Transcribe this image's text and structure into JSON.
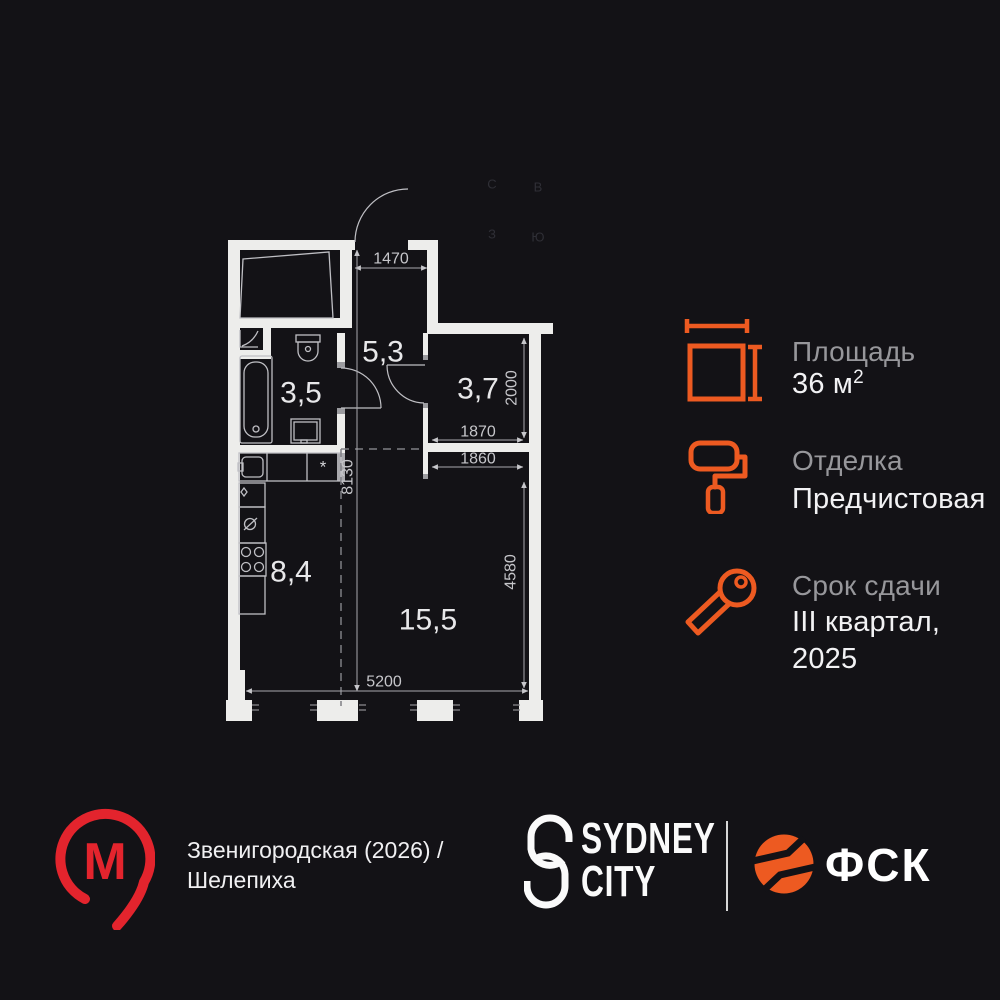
{
  "plan": {
    "room_labels": {
      "bathroom": "3,5",
      "hallway": "5,3",
      "bedroom": "3,7",
      "kitchen": "8,4",
      "living_room": "15,5"
    },
    "dimensions": {
      "hall_width": "1470",
      "bedroom_depth": "2000",
      "bedroom_width": "1870",
      "living_opening": "1860",
      "apartment_depth": "8130",
      "living_depth": "4580",
      "apartment_width": "5200"
    },
    "compass": {
      "north": "С",
      "east": "В",
      "west": "З",
      "south": "Ю"
    },
    "vent_symbol": "*"
  },
  "specs": {
    "area": {
      "label": "Площадь",
      "value": "36 м",
      "sup": "2"
    },
    "finishing": {
      "label": "Отделка",
      "value": "Предчистовая"
    },
    "deadline": {
      "label": "Срок сдачи",
      "line1": "III квартал,",
      "line2": "2025"
    }
  },
  "footer": {
    "metro": {
      "letter": "М",
      "line1": "Звенигородская (2026) /",
      "line2": "Шелепиха"
    },
    "sydney": {
      "line1": "SYDNEY",
      "line2": "CITY"
    },
    "fsk": {
      "name": "ФСК"
    }
  },
  "colors": {
    "background": "#131216",
    "wall": "#EDEDEB",
    "accent_orange": "#ED5A21",
    "metro_red": "#E3242D",
    "dim_text": "#C6C6CA",
    "label_gray": "#97979B",
    "value_white": "#F2F2F4"
  }
}
